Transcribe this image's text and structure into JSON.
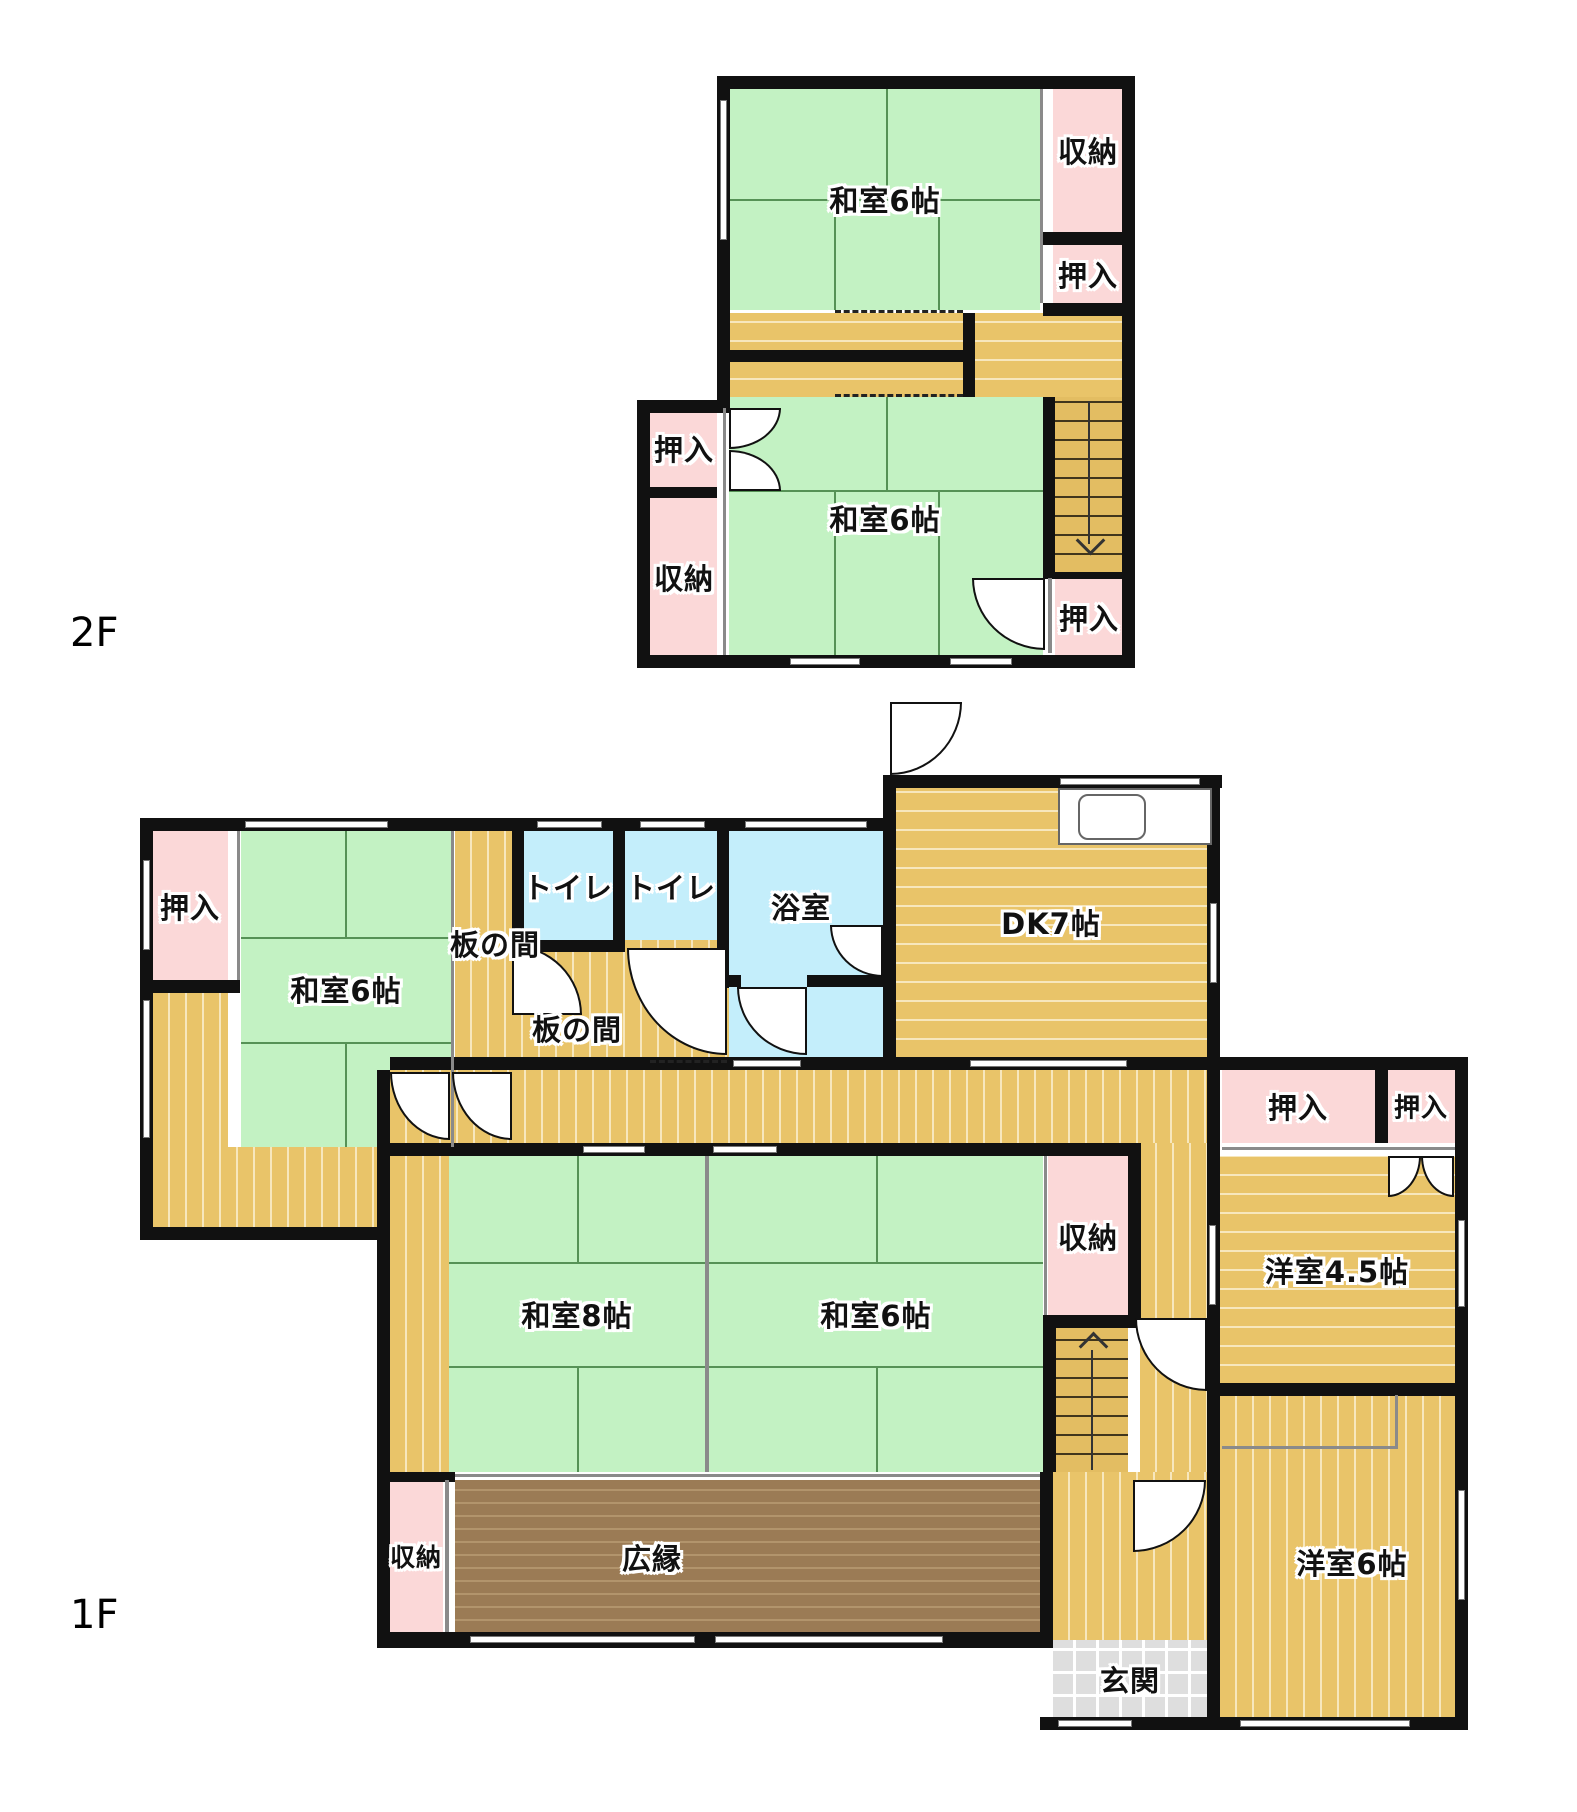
{
  "plan": {
    "title": "2-story Japanese house floor plan",
    "width": 1577,
    "height": 1812,
    "colors": {
      "wall": "#111111",
      "tatami_green": "#c3f2c3",
      "closet_pink": "#fbd8d8",
      "wood_yellow": "#e9c469",
      "bath_blue": "#c4eefb",
      "veranda_brown": "#9b7b55",
      "entrance_gray": "#dedede"
    },
    "floor_labels": [
      {
        "text": "2F",
        "x": 70,
        "y": 610
      },
      {
        "text": "1F",
        "x": 70,
        "y": 1592
      }
    ],
    "rooms": [
      {
        "name": "washitsu6-2f-upper",
        "label": "和室6帖",
        "x": 729,
        "y": 89,
        "w": 311,
        "h": 221,
        "fill": "tatami",
        "lx": 885,
        "ly": 199
      },
      {
        "name": "shuno-2f-right",
        "label": "収納",
        "x": 1053,
        "y": 89,
        "w": 69,
        "h": 143,
        "fill": "pink",
        "lx": 1088,
        "ly": 150
      },
      {
        "name": "oshiire-2f-right-top",
        "label": "押入",
        "x": 1053,
        "y": 245,
        "w": 69,
        "h": 58,
        "fill": "pink",
        "lx": 1088,
        "ly": 274
      },
      {
        "name": "corridor-2f",
        "label": "",
        "x": 729,
        "y": 313,
        "w": 393,
        "h": 84,
        "fill": "wood-h",
        "lx": 0,
        "ly": 0
      },
      {
        "name": "washitsu6-2f-lower",
        "label": "和室6帖",
        "x": 729,
        "y": 397,
        "w": 314,
        "h": 258,
        "fill": "tatami",
        "lx": 885,
        "ly": 518
      },
      {
        "name": "oshiire-2f-left",
        "label": "押入",
        "x": 650,
        "y": 408,
        "w": 67,
        "h": 80,
        "fill": "pink",
        "lx": 684,
        "ly": 448
      },
      {
        "name": "shuno-2f-left",
        "label": "収納",
        "x": 650,
        "y": 498,
        "w": 67,
        "h": 157,
        "fill": "pink",
        "lx": 684,
        "ly": 577
      },
      {
        "name": "oshiire-2f-right-bottom",
        "label": "押入",
        "x": 1055,
        "y": 578,
        "w": 67,
        "h": 77,
        "fill": "pink",
        "lx": 1089,
        "ly": 617
      },
      {
        "name": "oshiire-1f-topleft",
        "label": "押入",
        "x": 153,
        "y": 831,
        "w": 75,
        "h": 149,
        "fill": "pink",
        "lx": 190,
        "ly": 906
      },
      {
        "name": "engawa-strip-left",
        "label": "",
        "x": 153,
        "y": 993,
        "w": 75,
        "h": 154,
        "fill": "wood-v",
        "lx": 0,
        "ly": 0
      },
      {
        "name": "washitsu6-1f-topleft",
        "label": "和室6帖",
        "x": 241,
        "y": 831,
        "w": 210,
        "h": 316,
        "fill": "tatami",
        "lx": 346,
        "ly": 989
      },
      {
        "name": "itanoma-strip",
        "label": "板の間",
        "x": 455,
        "y": 831,
        "w": 57,
        "h": 226,
        "fill": "wood-v",
        "lx": 495,
        "ly": 943
      },
      {
        "name": "toilet-1",
        "label": "トイレ",
        "x": 524,
        "y": 831,
        "w": 89,
        "h": 109,
        "fill": "bath",
        "lx": 568,
        "ly": 886
      },
      {
        "name": "toilet-2",
        "label": "トイレ",
        "x": 625,
        "y": 831,
        "w": 92,
        "h": 109,
        "fill": "bath",
        "lx": 671,
        "ly": 886
      },
      {
        "name": "itanoma-lower",
        "label": "板の間",
        "x": 455,
        "y": 940,
        "w": 274,
        "h": 117,
        "fill": "wood-v",
        "lx": 577,
        "ly": 1028
      },
      {
        "name": "bathroom",
        "label": "浴室",
        "x": 729,
        "y": 818,
        "w": 154,
        "h": 239,
        "fill": "bath",
        "lx": 801,
        "ly": 906
      },
      {
        "name": "dk7",
        "label": "DK7帖",
        "x": 896,
        "y": 788,
        "w": 311,
        "h": 269,
        "fill": "wood-h",
        "lx": 1051,
        "ly": 922
      },
      {
        "name": "corridor-1f",
        "label": "",
        "x": 390,
        "y": 1070,
        "w": 817,
        "h": 73,
        "fill": "wood-v",
        "lx": 0,
        "ly": 0
      },
      {
        "name": "veranda-bottom-left",
        "label": "",
        "x": 153,
        "y": 1147,
        "w": 237,
        "h": 80,
        "fill": "wood-v",
        "lx": 0,
        "ly": 0
      },
      {
        "name": "engawa-strip-8",
        "label": "",
        "x": 390,
        "y": 1156,
        "w": 59,
        "h": 316,
        "fill": "wood-v",
        "lx": 0,
        "ly": 0
      },
      {
        "name": "washitsu8-1f",
        "label": "和室8帖",
        "x": 449,
        "y": 1156,
        "w": 256,
        "h": 316,
        "fill": "tatami",
        "lx": 577,
        "ly": 1314
      },
      {
        "name": "washitsu6-1f-center",
        "label": "和室6帖",
        "x": 709,
        "y": 1156,
        "w": 334,
        "h": 316,
        "fill": "tatami",
        "lx": 876,
        "ly": 1314
      },
      {
        "name": "shuno-1f-center",
        "label": "収納",
        "x": 1048,
        "y": 1156,
        "w": 80,
        "h": 159,
        "fill": "pink",
        "lx": 1088,
        "ly": 1236
      },
      {
        "name": "hallway-vertical",
        "label": "",
        "x": 1140,
        "y": 1143,
        "w": 67,
        "h": 337,
        "fill": "wood-v",
        "lx": 0,
        "ly": 0
      },
      {
        "name": "hallway-lower",
        "label": "",
        "x": 1053,
        "y": 1472,
        "w": 154,
        "h": 168,
        "fill": "wood-v",
        "lx": 0,
        "ly": 0
      },
      {
        "name": "genkan",
        "label": "玄関",
        "x": 1053,
        "y": 1640,
        "w": 154,
        "h": 77,
        "fill": "genkan",
        "lx": 1130,
        "ly": 1679
      },
      {
        "name": "oshiire-1f-wide",
        "label": "押入",
        "x": 1222,
        "y": 1070,
        "w": 153,
        "h": 73,
        "fill": "pink",
        "lx": 1298,
        "ly": 1106
      },
      {
        "name": "oshiire-1f-small",
        "label": "押入",
        "x": 1388,
        "y": 1070,
        "w": 67,
        "h": 73,
        "fill": "pink",
        "lx": 1421,
        "ly": 1106,
        "size": 26
      },
      {
        "name": "yoshitsu45",
        "label": "洋室4.5帖",
        "x": 1220,
        "y": 1156,
        "w": 235,
        "h": 227,
        "fill": "wood-h",
        "lx": 1337,
        "ly": 1270
      },
      {
        "name": "yoshitsu6",
        "label": "洋室6帖",
        "x": 1220,
        "y": 1395,
        "w": 235,
        "h": 322,
        "fill": "wood-v",
        "lx": 1352,
        "ly": 1562
      },
      {
        "name": "hiroen",
        "label": "広縁",
        "x": 455,
        "y": 1480,
        "w": 585,
        "h": 152,
        "fill": "brown",
        "lx": 652,
        "ly": 1557
      },
      {
        "name": "shuno-1f-bottomleft",
        "label": "収納",
        "x": 390,
        "y": 1480,
        "w": 53,
        "h": 152,
        "fill": "pink",
        "lx": 416,
        "ly": 1556,
        "size": 25
      }
    ],
    "walls": [
      [
        717,
        76,
        418,
        13
      ],
      [
        1122,
        76,
        13,
        592
      ],
      [
        637,
        655,
        498,
        13
      ],
      [
        717,
        76,
        13,
        332
      ],
      [
        637,
        400,
        13,
        268
      ],
      [
        637,
        400,
        92,
        13
      ],
      [
        1043,
        232,
        92,
        13
      ],
      [
        1043,
        303,
        92,
        13
      ],
      [
        729,
        350,
        234,
        12
      ],
      [
        963,
        313,
        12,
        84
      ],
      [
        1043,
        397,
        12,
        182
      ],
      [
        1043,
        572,
        92,
        7
      ],
      [
        643,
        487,
        74,
        11
      ],
      [
        140,
        818,
        13,
        422
      ],
      [
        140,
        818,
        745,
        13
      ],
      [
        883,
        775,
        13,
        295
      ],
      [
        883,
        775,
        339,
        13
      ],
      [
        390,
        1057,
        832,
        13
      ],
      [
        1207,
        1057,
        261,
        13
      ],
      [
        1455,
        1057,
        13,
        673
      ],
      [
        1207,
        775,
        13,
        295
      ],
      [
        140,
        1227,
        250,
        13
      ],
      [
        140,
        980,
        100,
        13
      ],
      [
        512,
        818,
        12,
        130
      ],
      [
        613,
        818,
        12,
        130
      ],
      [
        717,
        818,
        12,
        170
      ],
      [
        512,
        940,
        113,
        12
      ],
      [
        725,
        975,
        16,
        12
      ],
      [
        807,
        975,
        76,
        12
      ],
      [
        377,
        1070,
        13,
        86
      ],
      [
        377,
        1143,
        764,
        13
      ],
      [
        377,
        1143,
        13,
        505
      ],
      [
        1128,
        1156,
        13,
        172
      ],
      [
        1043,
        1315,
        97,
        13
      ],
      [
        1043,
        1315,
        13,
        157
      ],
      [
        1040,
        1472,
        13,
        176
      ],
      [
        1207,
        1070,
        13,
        325
      ],
      [
        1207,
        1383,
        13,
        347
      ],
      [
        1207,
        1383,
        261,
        13
      ],
      [
        1040,
        1717,
        428,
        13
      ],
      [
        377,
        1632,
        663,
        16
      ],
      [
        377,
        1472,
        78,
        10
      ],
      [
        1375,
        1070,
        13,
        73
      ]
    ],
    "partitions": [
      [
        237,
        831,
        3,
        149
      ],
      [
        451,
        831,
        3,
        316
      ],
      [
        705,
        1156,
        4,
        316
      ],
      [
        1044,
        1156,
        3,
        159
      ],
      [
        1222,
        1147,
        233,
        3
      ],
      [
        455,
        1474,
        585,
        3
      ],
      [
        445,
        1480,
        4,
        152
      ],
      [
        723,
        408,
        3,
        247
      ],
      [
        1040,
        89,
        3,
        214
      ],
      [
        1048,
        578,
        4,
        75
      ],
      [
        1222,
        1446,
        176,
        3
      ],
      [
        1395,
        1395,
        3,
        53
      ]
    ],
    "windows": [
      [
        720,
        100,
        7,
        140
      ],
      [
        790,
        658,
        70,
        7
      ],
      [
        950,
        658,
        62,
        7
      ],
      [
        245,
        821,
        143,
        7
      ],
      [
        537,
        821,
        65,
        7
      ],
      [
        640,
        821,
        65,
        7
      ],
      [
        745,
        821,
        122,
        7
      ],
      [
        1060,
        778,
        140,
        7
      ],
      [
        1210,
        903,
        7,
        80
      ],
      [
        143,
        860,
        7,
        90
      ],
      [
        143,
        1000,
        7,
        138
      ],
      [
        583,
        1146,
        62,
        7
      ],
      [
        713,
        1146,
        64,
        7
      ],
      [
        733,
        1060,
        68,
        7
      ],
      [
        970,
        1060,
        157,
        7
      ],
      [
        470,
        1636,
        225,
        7
      ],
      [
        715,
        1636,
        228,
        7
      ],
      [
        1058,
        1720,
        74,
        7
      ],
      [
        1240,
        1720,
        170,
        7
      ],
      [
        1458,
        1220,
        7,
        87
      ],
      [
        1209,
        1225,
        7,
        80
      ],
      [
        1458,
        1490,
        7,
        110
      ]
    ],
    "dashes": [
      [
        835,
        310,
        128
      ],
      [
        835,
        394,
        128
      ],
      [
        650,
        1060,
        77
      ]
    ],
    "doors": [
      {
        "x": 729,
        "y": 408,
        "w": 52,
        "h": 41,
        "corner": "br"
      },
      {
        "x": 729,
        "y": 450,
        "w": 52,
        "h": 41,
        "corner": "tr"
      },
      {
        "x": 972,
        "y": 578,
        "w": 73,
        "h": 72,
        "corner": "bl"
      },
      {
        "x": 890,
        "y": 702,
        "w": 72,
        "h": 73,
        "corner": "br"
      },
      {
        "x": 737,
        "y": 987,
        "w": 70,
        "h": 68,
        "corner": "bl"
      },
      {
        "x": 830,
        "y": 925,
        "w": 53,
        "h": 52,
        "corner": "bl"
      },
      {
        "x": 512,
        "y": 945,
        "w": 70,
        "h": 70,
        "corner": "tr"
      },
      {
        "x": 627,
        "y": 948,
        "w": 100,
        "h": 107,
        "corner": "bl"
      },
      {
        "x": 390,
        "y": 1072,
        "w": 60,
        "h": 68,
        "corner": "bl"
      },
      {
        "x": 452,
        "y": 1072,
        "w": 60,
        "h": 68,
        "corner": "bl"
      },
      {
        "x": 1135,
        "y": 1318,
        "w": 72,
        "h": 73,
        "corner": "bl"
      },
      {
        "x": 1133,
        "y": 1480,
        "w": 73,
        "h": 72,
        "corner": "br"
      },
      {
        "x": 1388,
        "y": 1156,
        "w": 33,
        "h": 41,
        "corner": "br"
      },
      {
        "x": 1421,
        "y": 1156,
        "w": 33,
        "h": 41,
        "corner": "bl"
      }
    ],
    "tatami_lines": [
      [
        886,
        89,
        2,
        110
      ],
      [
        730,
        199,
        310,
        2
      ],
      [
        834,
        199,
        2,
        111
      ],
      [
        938,
        199,
        2,
        111
      ],
      [
        886,
        397,
        2,
        93
      ],
      [
        729,
        490,
        314,
        2
      ],
      [
        834,
        490,
        2,
        165
      ],
      [
        938,
        490,
        2,
        165
      ],
      [
        345,
        831,
        2,
        106
      ],
      [
        241,
        937,
        210,
        2
      ],
      [
        241,
        1042,
        210,
        2
      ],
      [
        345,
        1042,
        2,
        105
      ],
      [
        449,
        1262,
        256,
        2
      ],
      [
        449,
        1366,
        256,
        2
      ],
      [
        577,
        1156,
        2,
        106
      ],
      [
        577,
        1366,
        2,
        106
      ],
      [
        709,
        1262,
        334,
        2
      ],
      [
        709,
        1366,
        334,
        2
      ],
      [
        876,
        1156,
        2,
        106
      ],
      [
        876,
        1366,
        2,
        106
      ]
    ],
    "stairs": [
      {
        "name": "staircase-2f",
        "x": 1055,
        "y": 397,
        "w": 67,
        "h": 175,
        "dir": "down"
      },
      {
        "name": "staircase-1f",
        "x": 1056,
        "y": 1328,
        "w": 72,
        "h": 144,
        "dir": "up"
      }
    ],
    "kitchen": {
      "counter": [
        1058,
        788,
        154,
        57
      ],
      "sink": [
        1078,
        794,
        68,
        46
      ]
    }
  }
}
